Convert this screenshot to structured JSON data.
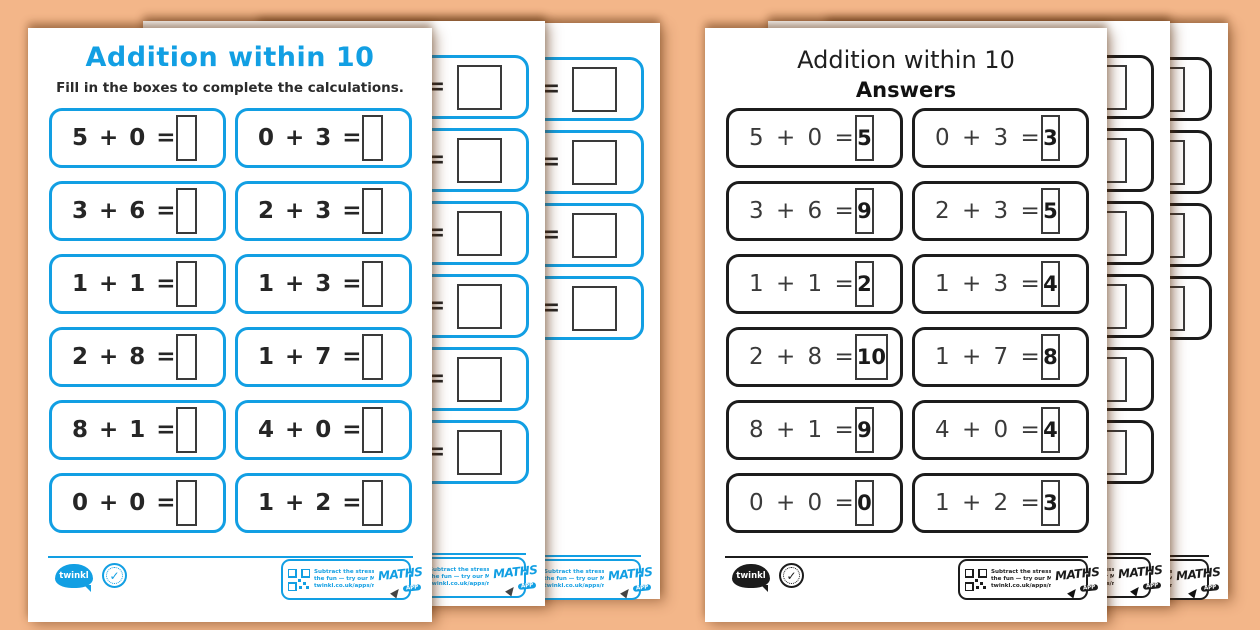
{
  "colors": {
    "background": "#f3b689",
    "accent_blue": "#129fe3",
    "ink": "#262626"
  },
  "worksheet_page": {
    "title": "Addition within 10",
    "instructions": "Fill in the boxes to complete the calculations."
  },
  "answers_page": {
    "title": "Addition within 10",
    "subtitle": "Answers"
  },
  "problems": [
    {
      "expr": "5 + 0 =",
      "answer": "5"
    },
    {
      "expr": "0 + 3 =",
      "answer": "3"
    },
    {
      "expr": "3 + 6 =",
      "answer": "9"
    },
    {
      "expr": "2 + 3 =",
      "answer": "5"
    },
    {
      "expr": "1 + 1 =",
      "answer": "2"
    },
    {
      "expr": "1 + 3 =",
      "answer": "4"
    },
    {
      "expr": "2 + 8 =",
      "answer": "10"
    },
    {
      "expr": "1 + 7 =",
      "answer": "8"
    },
    {
      "expr": "8 + 1 =",
      "answer": "9"
    },
    {
      "expr": "4 + 0 =",
      "answer": "4"
    },
    {
      "expr": "0 + 0 =",
      "answer": "0"
    },
    {
      "expr": "1 + 2 =",
      "answer": "3"
    }
  ],
  "fragments": {
    "equals": "="
  },
  "footer": {
    "twinkl_label": "twinkl",
    "badge_check": "✓",
    "promo_line1": "Subtract the stress, multiply",
    "promo_line2": "the fun — try our Maths App!",
    "promo_line3": "twinkl.co.uk/apps/maths",
    "app_word": "MATHS",
    "app_badge": "APP"
  }
}
